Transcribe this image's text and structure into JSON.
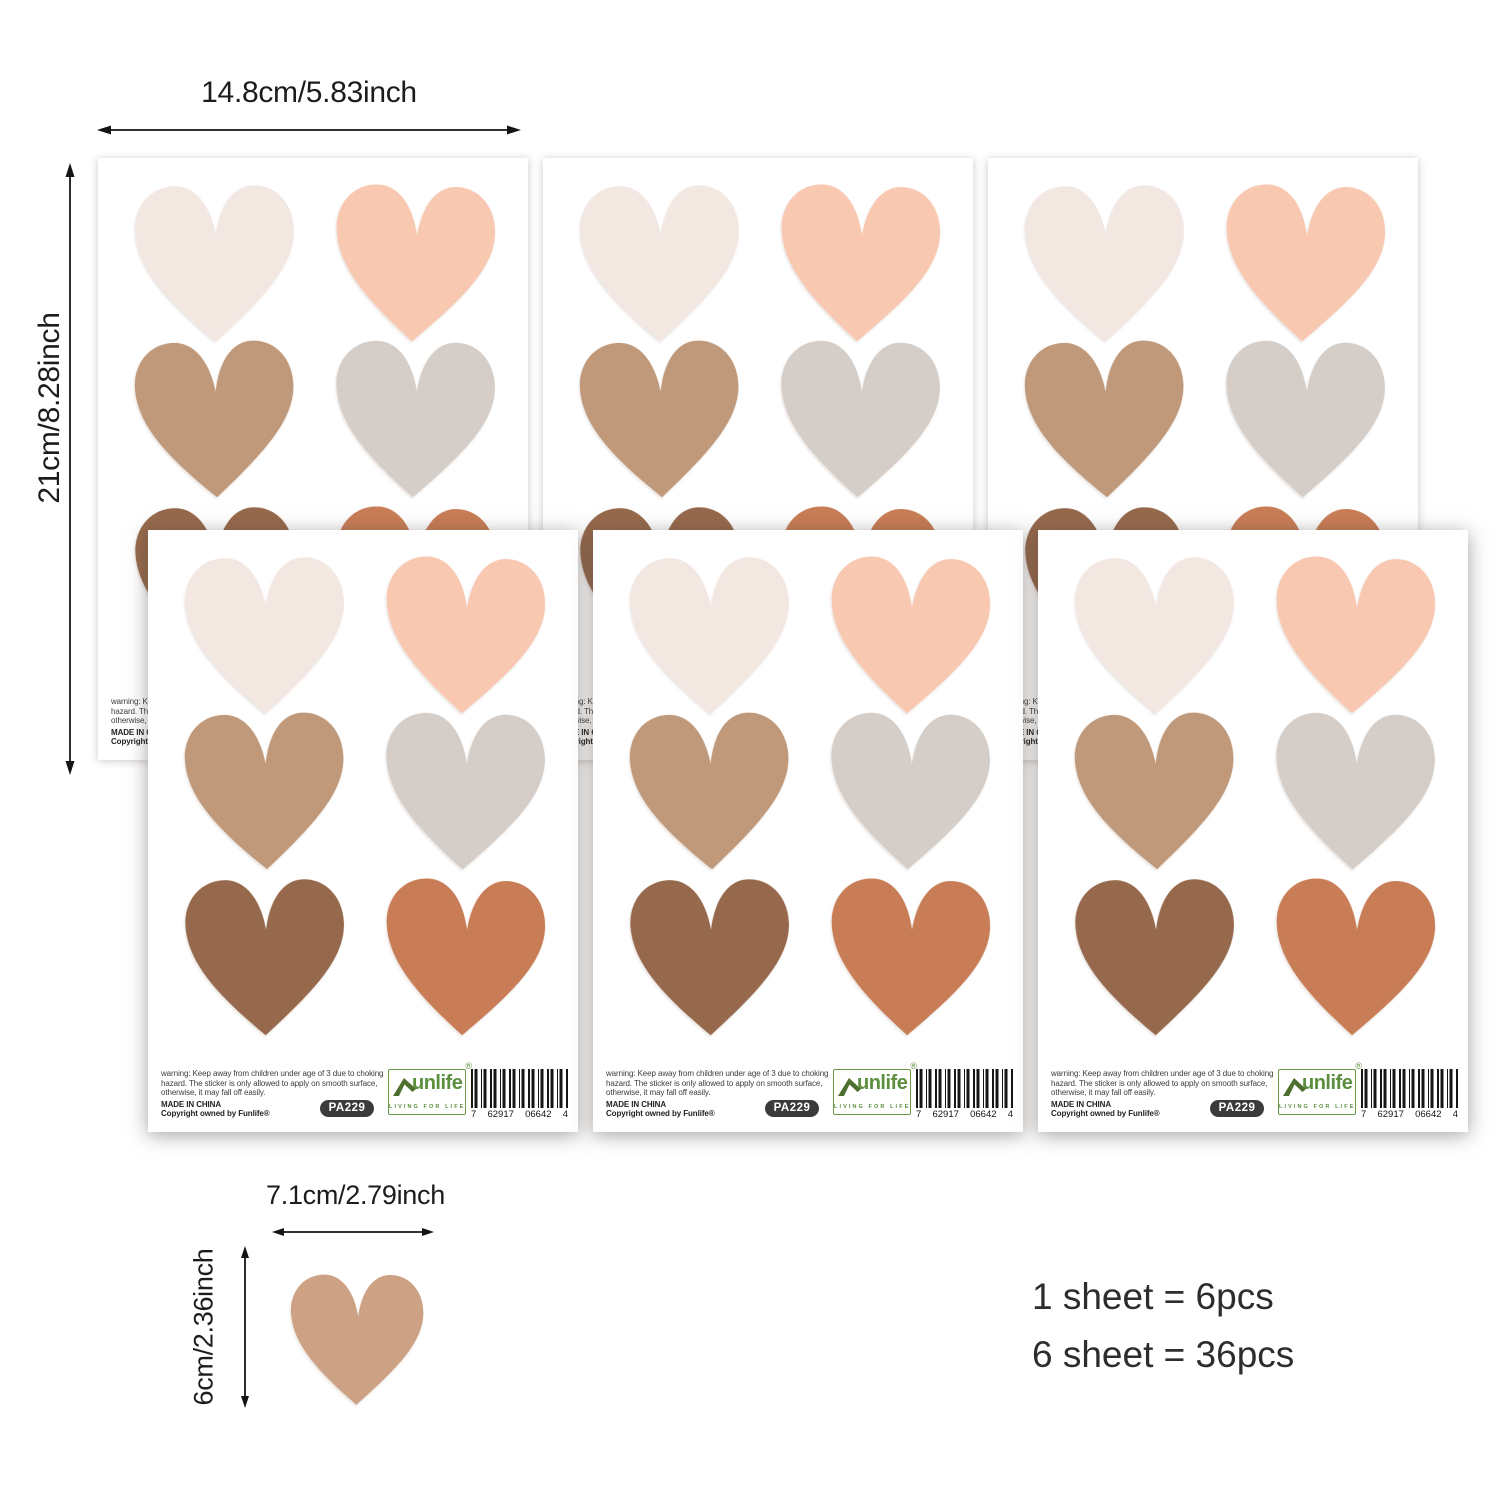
{
  "dimensions": {
    "sheet_width_label": "14.8cm/5.83inch",
    "sheet_height_label": "21cm/8.28inch",
    "sample_heart_width_label": "7.1cm/2.79inch",
    "sample_heart_height_label": "6cm/2.36inch"
  },
  "packaging_note": {
    "line1": "1 sheet = 6pcs",
    "line2": "6 sheet = 36pcs"
  },
  "sheet": {
    "warning_lines": [
      "warning: Keep away from children under age of 3 due to choking",
      "hazard. The sticker is only allowed to apply on smooth surface,",
      "otherwise, it may fall off easily."
    ],
    "made_in": "MADE IN CHINA",
    "copyright": "Copyright owned by Funlife®",
    "sku_badge": "PA229",
    "logo": {
      "brand": "unlife",
      "registered": "®",
      "tagline": "LIVING FOR LIFE"
    },
    "barcode_digits": {
      "lead": "7",
      "group1": "62917",
      "group2": "06642",
      "check": "4"
    }
  },
  "hearts": {
    "sheet_colors": [
      {
        "name": "cream-blush",
        "hex": "#f3e7e2"
      },
      {
        "name": "peach-pink",
        "hex": "#f8c8b1"
      },
      {
        "name": "tan-brown",
        "hex": "#c0997a"
      },
      {
        "name": "taupe-gray",
        "hex": "#d5cec8"
      },
      {
        "name": "dark-brown",
        "hex": "#96694c"
      },
      {
        "name": "terracotta",
        "hex": "#c87d56"
      }
    ],
    "sample_color": "#cda184"
  },
  "brand_colors": {
    "logo_green": "#5b8f3e",
    "roof_green": "#4d7030",
    "badge_dark": "#3b3b3d"
  },
  "counts": {
    "sheets_shown": 6,
    "hearts_per_sheet": 6
  }
}
